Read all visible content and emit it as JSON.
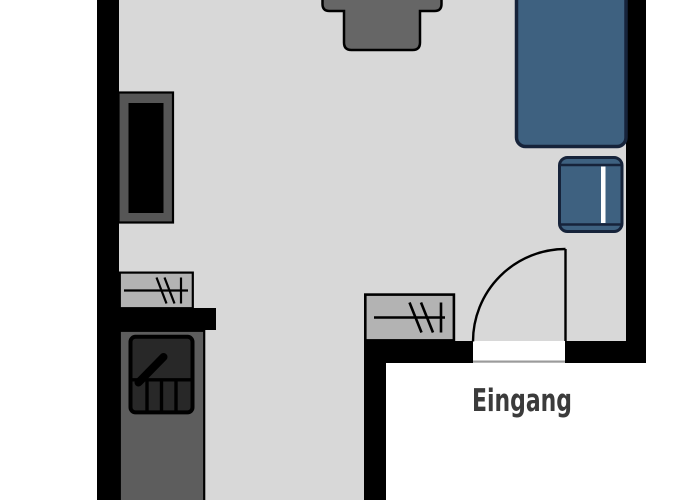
{
  "labels": {
    "entrance": "Eingang"
  },
  "colors": {
    "outside": "#ffffff",
    "wall": "#000000",
    "floor": "#d8d8d8",
    "stroke": "#000000",
    "bed_fill": "#3e6180",
    "bed_border": "#16233a",
    "side_table_stripe": "#ffffff",
    "radiator_fill": "#b3b3b3",
    "kitchen_fill": "#5d5d5d",
    "appliance_fill": "#282828",
    "wardrobe_frame": "#565656",
    "wardrobe_door": "#000000",
    "desk_fill": "#666666",
    "door_gap": "#ffffff",
    "threshold_line": "#9b9b9b",
    "label_text": "#3b3b3b"
  }
}
